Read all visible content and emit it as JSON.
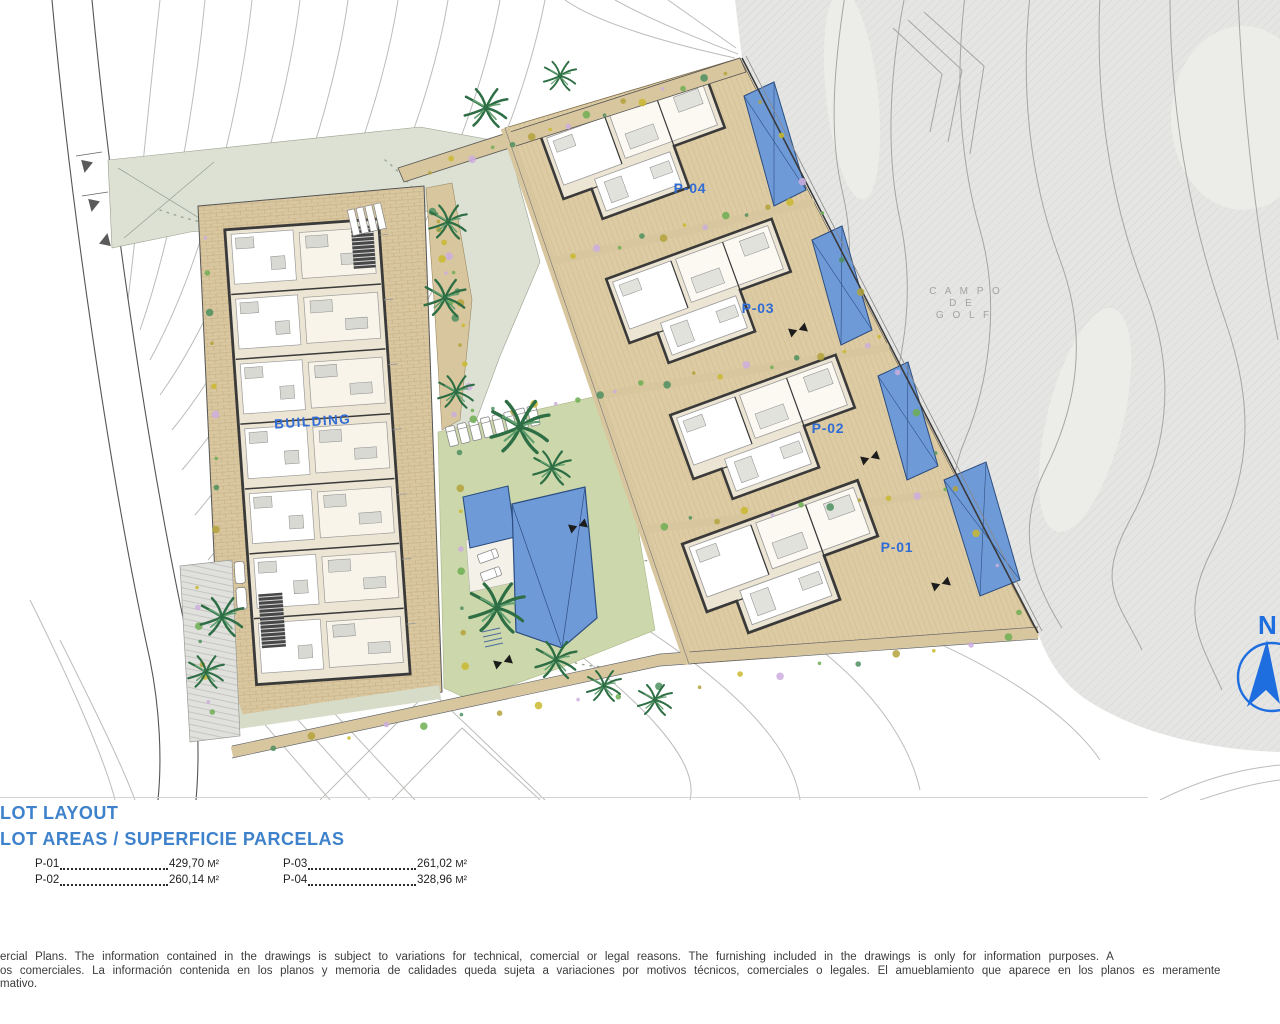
{
  "plan": {
    "building_label": "BUILDING",
    "plot_labels": {
      "p04": "P-04",
      "p03": "P-03",
      "p02": "P-02",
      "p01": "P-01"
    },
    "golf_text": {
      "line1": "C A M P O",
      "line2": "D E",
      "line3": "G O L F"
    },
    "compass": {
      "north_label": "N"
    }
  },
  "legend": {
    "title_line1": "LOT LAYOUT",
    "title_line2": "LOT AREAS / SUPERFICIE PARCELAS",
    "plots": [
      {
        "id": "P-01",
        "area": "429,70",
        "unit": "M²"
      },
      {
        "id": "P-02",
        "area": "260,14",
        "unit": "M²"
      },
      {
        "id": "P-03",
        "area": "261,02",
        "unit": "M²"
      },
      {
        "id": "P-04",
        "area": "328,96",
        "unit": "M²"
      }
    ]
  },
  "disclaimer": {
    "line1": "ercial Plans. The information contained in the drawings is subject to variations for technical, comercial or legal reasons. The furnishing included in the drawings is only for information purposes. A",
    "line2": "os comerciales. La información contenida en los planos y memoria de calidades queda sujeta a variaciones por motivos técnicos, comerciales o legales. El amueblamiento que aparece en los planos es meramente",
    "line3": "mativo."
  },
  "colors": {
    "accent_blue": "#2f6cd6",
    "title_blue": "#3e82cb",
    "pool_blue": "#6f9ad8"
  }
}
